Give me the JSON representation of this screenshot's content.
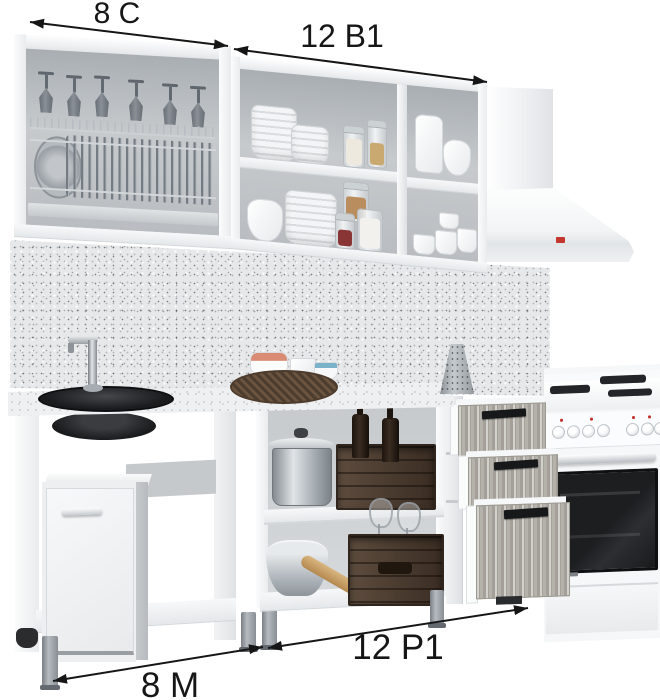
{
  "annotations": {
    "wall_left": {
      "label": "8 С"
    },
    "wall_right": {
      "label": "12 В1"
    },
    "base_left": {
      "label": "8 М"
    },
    "base_right": {
      "label": "12 Р1"
    }
  },
  "scene": {
    "type": "kitchen-set-product-render",
    "modules": [
      "wall-dish-dryer-cabinet",
      "wall-open-shelf-cabinet",
      "chimney-extractor-hood",
      "sink-base-cabinet",
      "open-work-base-cabinet",
      "three-drawer-unit",
      "freestanding-stove"
    ]
  },
  "colors": {
    "annotation": "#161616",
    "cabinet_white": "#f2f3f4",
    "backsplash_base": "#e7e8e9",
    "countertop_base": "#eff0f1",
    "drawer_front_wood": "#b5b2ab",
    "handle_dark": "#17181a",
    "sink_black": "#1a1b1d",
    "crate_wood": "#4a3b2f",
    "hood_logo_red": "#c4372e",
    "steel": "#b7bdc2"
  }
}
